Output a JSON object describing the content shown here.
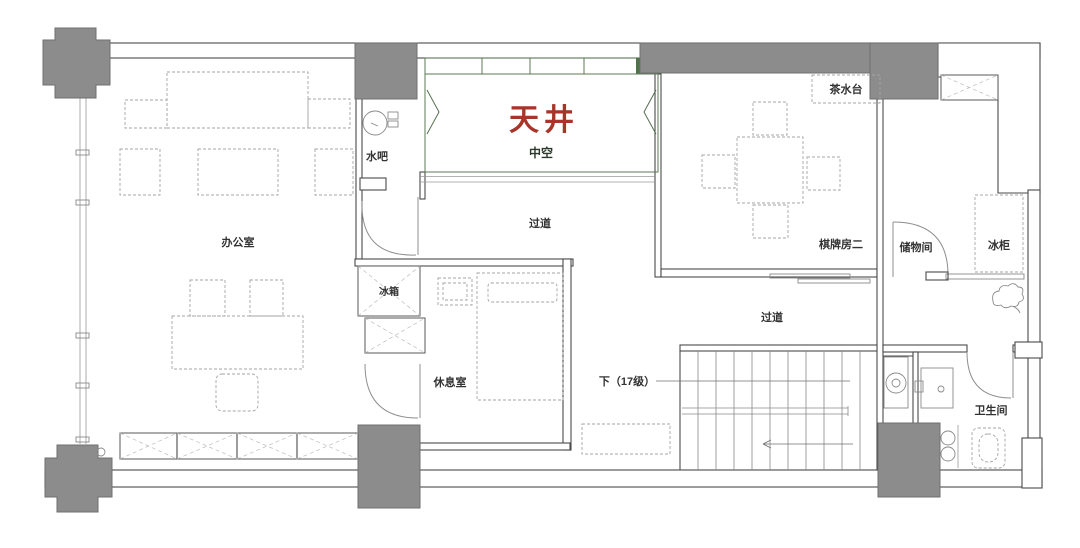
{
  "labels": {
    "office": "办公室",
    "water_bar": "水吧",
    "atrium": "天井",
    "atrium_sub": "中空",
    "corridor_upper": "过道",
    "tea_station": "茶水台",
    "chess_room": "棋牌房二",
    "storage_room": "储物间",
    "freezer": "冰柜",
    "fridge": "冰箱",
    "rest_room": "休息室",
    "corridor_lower": "过道",
    "stairs_down": "下（17级）",
    "bathroom": "卫生间"
  },
  "colors": {
    "column_gray": "#8C8C8C",
    "atrium_green": "#8CA986",
    "atrium_green_dark": "#7E9D77",
    "atrium_green_deep": "#4F7348",
    "atrium_red": "#A8352A",
    "atrium_sub_dark": "#2B3A2B",
    "label_dark": "#333333"
  }
}
